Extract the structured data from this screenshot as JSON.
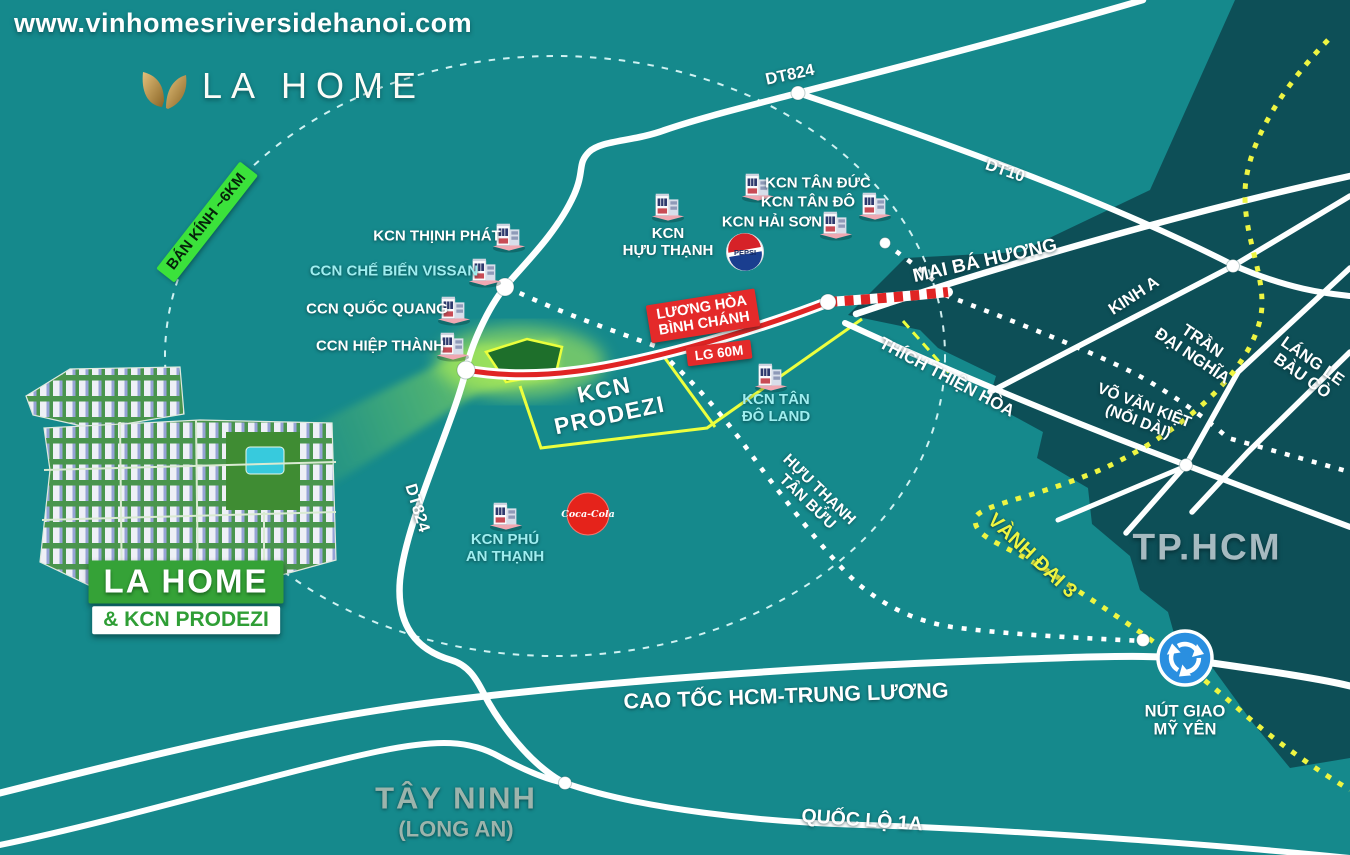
{
  "watermark": "www.vinhomesriversidehanoi.com",
  "logo": {
    "brand": "LA HOME"
  },
  "radius_badge": "BÁN KÍNH ~6KM",
  "site_label": {
    "title": "LA HOME",
    "subtitle": "& KCN PRODEZI"
  },
  "prodezi": {
    "line1": "KCN",
    "line2": "PRODEZI"
  },
  "route_badge": {
    "line1": "LƯƠNG HÒA",
    "line2": "BÌNH CHÁNH",
    "width_note": "LG 60M"
  },
  "parks": [
    {
      "id": "thinh-phat",
      "label": "KCN THỊNH PHÁT"
    },
    {
      "id": "vissan",
      "label": "CCN CHẾ BIẾN VISSAN"
    },
    {
      "id": "quoc-quang",
      "label": "CCN QUỐC QUANG"
    },
    {
      "id": "hiep-thanh",
      "label": "CCN HIỆP THÀNH"
    },
    {
      "id": "huu-thanh",
      "line1": "KCN",
      "line2": "HỰU THẠNH"
    },
    {
      "id": "tan-duc",
      "label": "KCN TÂN ĐỨC"
    },
    {
      "id": "tan-do",
      "label": "KCN TÂN ĐÔ"
    },
    {
      "id": "hai-son",
      "label": "KCN HẢI SƠN"
    },
    {
      "id": "tan-do-land",
      "line1": "KCN TÂN",
      "line2": "ĐÔ LAND"
    },
    {
      "id": "phu-an-thanh",
      "line1": "KCN PHÚ",
      "line2": "AN THẠNH"
    }
  ],
  "roads": {
    "dt824": "DT824",
    "dt824_south": "DT824",
    "dt10": "DT10",
    "mai_ba_huong": "MAI BÁ HƯƠNG",
    "kinh_a": "KINH A",
    "tran_dai_nghia": {
      "line1": "TRẦN",
      "line2": "ĐẠI NGHĨA"
    },
    "lang_le": {
      "line1": "LÁNG LE",
      "line2": "BÀU CÒ"
    },
    "vo_van_kiet": {
      "line1": "VÕ VĂN KIỆT",
      "line2": "(NỐI DÀI)"
    },
    "thich_thien_hoa": "THÍCH THIỆN HÒA",
    "huu_thanh_tan_buu": {
      "line1": "HỰU THẠNH",
      "line2": "TÂN BỬU"
    },
    "vanh_dai_3": "VÀNH ĐAI 3",
    "cao_toc": "CAO TỐC HCM-TRUNG LƯƠNG",
    "quoc_lo_1a": "QUỐC LỘ 1A"
  },
  "regions": {
    "tphcm": "TP.HCM",
    "tay_ninh": "TÂY NINH",
    "tay_ninh_sub": "(LONG AN)"
  },
  "interchange": {
    "line1": "NÚT GIAO",
    "line2": "MỸ YÊN"
  },
  "brands": {
    "pepsi": "PEPSI",
    "coke": "Coca-Cola"
  },
  "colors": {
    "sea_teal": "#15898c",
    "dark_region": "#0d4f57",
    "route_red": "#e42a2a",
    "badge_green": "#3be23b",
    "site_green": "#35a237",
    "ring_yellow": "#eef542",
    "boundary_yellow": "#ecff3e",
    "label_cyan": "#9feef0",
    "region_text": "#a6bac0"
  }
}
